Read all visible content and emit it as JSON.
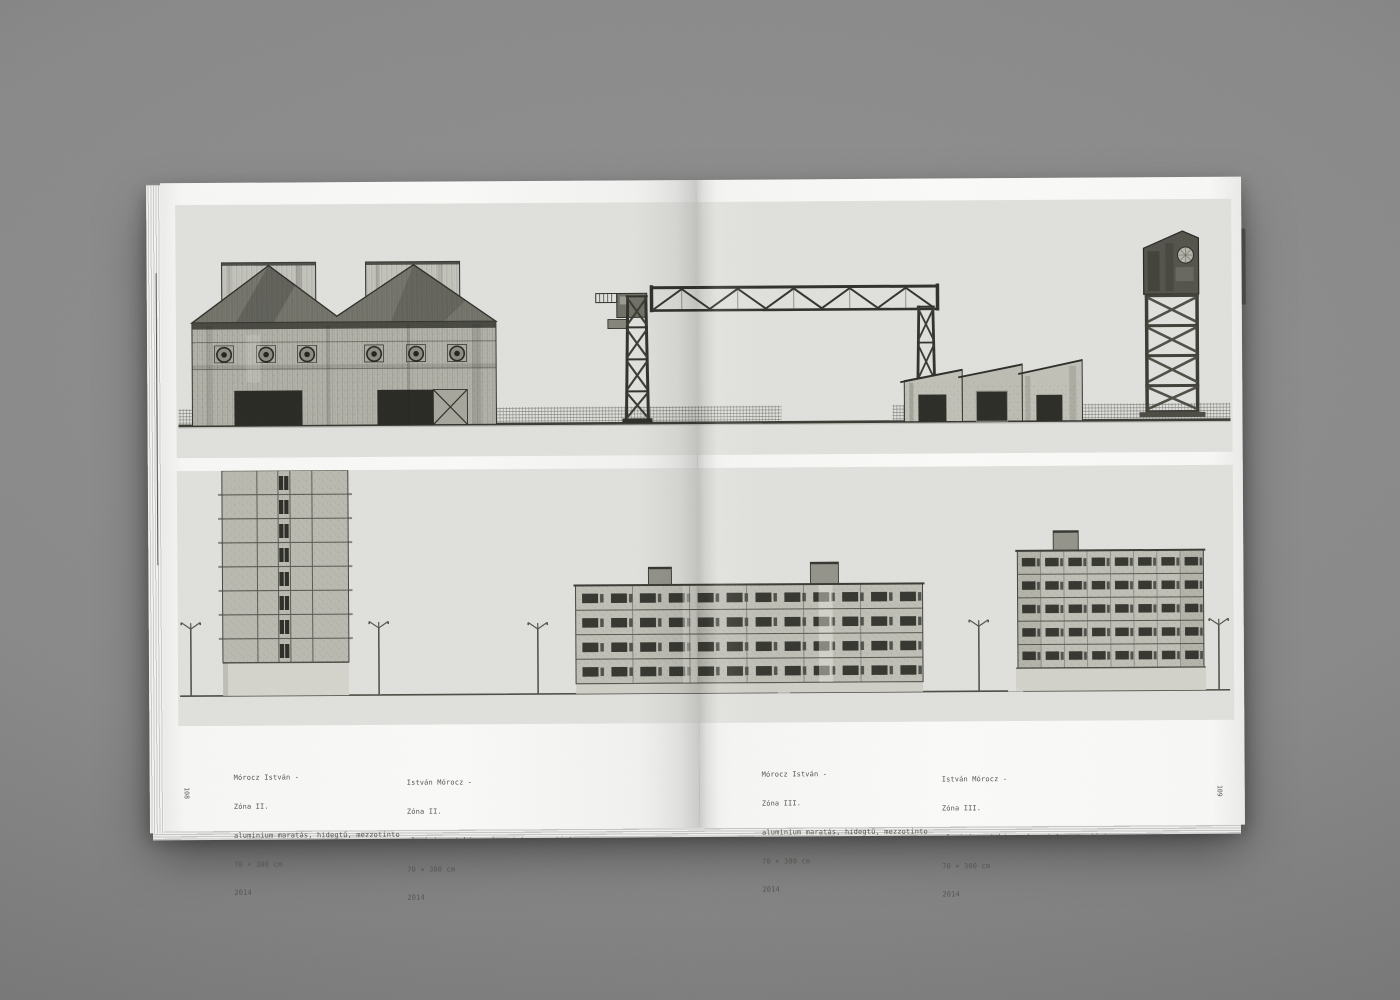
{
  "pages": {
    "left": {
      "page_number": "108",
      "captions": [
        {
          "artist": "Mórocz István -",
          "title": "Zóna II.",
          "technique": "aluminium maratás, hidegtű, mezzotinto",
          "dimensions": "70 × 300 cm",
          "year": "2014"
        },
        {
          "artist": "István Mórocz -",
          "title": "Zóna II.",
          "technique": "aluminium etching, drypoint, mezzotinto,",
          "dimensions": "70 × 300 cm",
          "year": "2014"
        }
      ]
    },
    "right": {
      "page_number": "109",
      "captions": [
        {
          "artist": "Mórocz István -",
          "title": "Zóna III.",
          "technique": "aluminium maratás, hidegtű, mezzotinto",
          "dimensions": "70 × 300 cm",
          "year": "2014"
        },
        {
          "artist": "István Mórocz -",
          "title": "Zóna III.",
          "technique": "aluminium etching, drypoint, mezzotinto,",
          "dimensions": "70 × 300 cm",
          "year": "2014"
        }
      ]
    }
  },
  "artworks": {
    "top_plate": "industrial-zone-elevation",
    "bottom_plate": "housing-estate-elevation"
  },
  "colors": {
    "backdrop": "#858585",
    "page": "#f7f7f5",
    "plate_background": "#e0e0dd",
    "ink": "#33332e",
    "caption_text": "#54524e"
  }
}
